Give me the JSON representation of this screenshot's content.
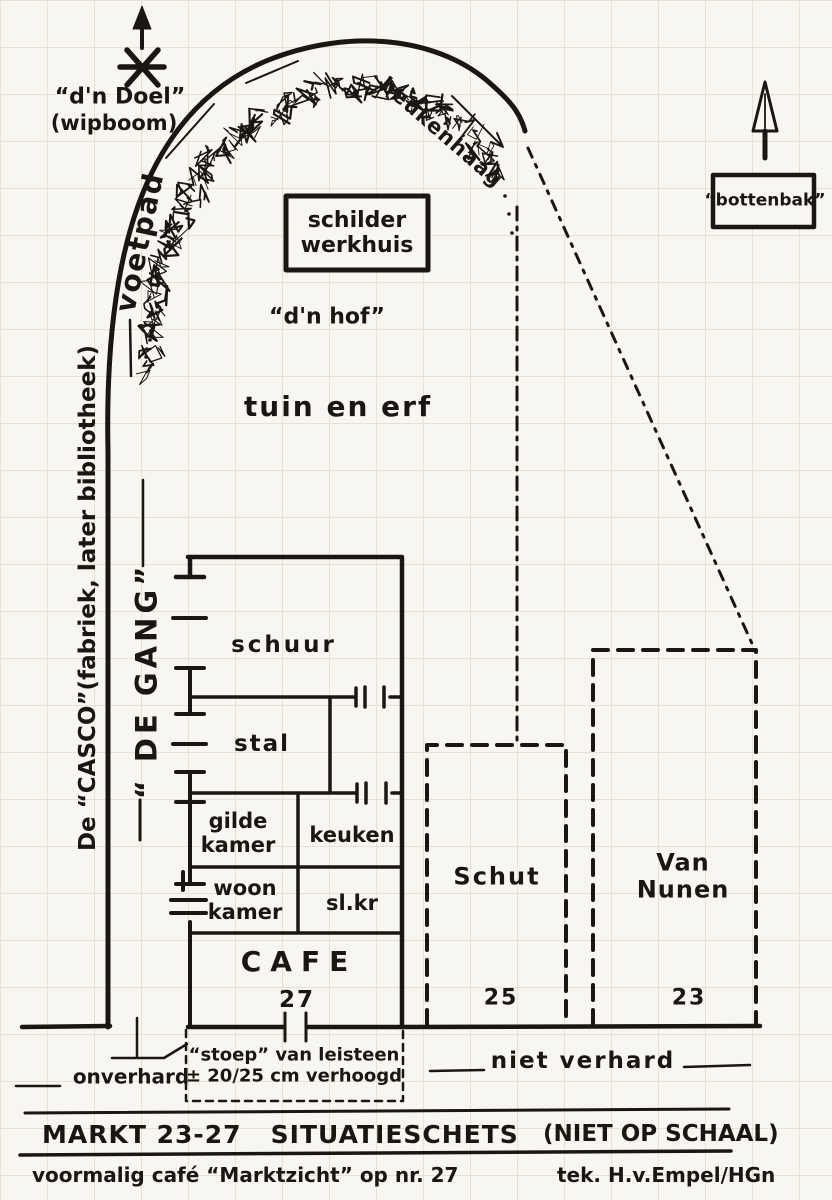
{
  "colors": {
    "ink": "#1b1611",
    "paper": "#f8f6f0",
    "grid": "#e7e1d3"
  },
  "map": {
    "doel_label": "“d'n Doel”",
    "doel_sub": "(wipboom)",
    "voetpad": "voetpad",
    "beukenhaag": "beukenhaag",
    "bottenbak": "“bottenbak”",
    "schilder_werkhuis": "schilder\nwerkhuis",
    "hof": "“d'n hof”",
    "tuin_en_erf": "tuin en erf",
    "casco": "De “CASCO”(fabriek, later bibliotheek)",
    "de_gang": "“ DE GANG”"
  },
  "building": {
    "schuur": "schuur",
    "stal": "stal",
    "gilde_kamer": "gilde\nkamer",
    "keuken": "keuken",
    "woon_kamer": "woon\nkamer",
    "slaapkamer": "sl.kr",
    "cafe": "CAFE",
    "cafe_number": "27"
  },
  "neighbors": [
    {
      "name": "Schut",
      "number": "25"
    },
    {
      "name": "Van Nunen",
      "number": "23"
    }
  ],
  "ground": {
    "onverhard": "onverhard",
    "niet_verhard": "niet verhard",
    "stoep_note": "“stoep” van leisteen\n± 20/25 cm verhoogd"
  },
  "title_block": {
    "title": "MARKT 23-27   SITUATIESCHETS",
    "scale_note": "(NIET OP SCHAAL)",
    "subtitle": "voormalig café “Marktzicht” op nr. 27",
    "credit": "tek. H.v.Empel/HGn"
  }
}
